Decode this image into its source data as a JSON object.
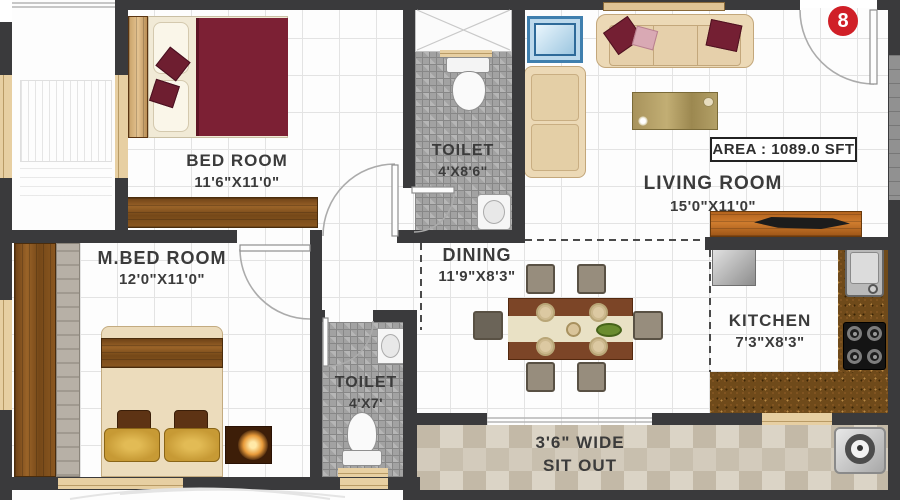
{
  "unit_badge": {
    "number": "8"
  },
  "area_box": {
    "label": "AREA : 1089.0 SFT"
  },
  "rooms": {
    "bedroom": {
      "name": "BED ROOM",
      "dims": "11'6\"X11'0\""
    },
    "toilet_top": {
      "name": "TOILET",
      "dims": "4'X8'6\""
    },
    "living": {
      "name": "LIVING ROOM",
      "dims": "15'0\"X11'0\""
    },
    "master_bedroom": {
      "name": "M.BED ROOM",
      "dims": "12'0\"X11'0\""
    },
    "dining": {
      "name": "DINING",
      "dims": "11'9\"X8'3\""
    },
    "kitchen": {
      "name": "KITCHEN",
      "dims": "7'3\"X8'3\""
    },
    "toilet_bottom": {
      "name": "TOILET",
      "dims": "4'X7'"
    },
    "sitout": {
      "line1": "3'6\" WIDE",
      "line2": "SIT OUT"
    }
  },
  "colors": {
    "wall": "#3a3a3c",
    "bed_maroon": "#7c2034",
    "badge_red": "#d01f27",
    "counter_brown": "#6f4a1a",
    "pillow_gold": "#c79a35",
    "window_tan": "#e7cfa2",
    "sofa_cream": "#ecd9b6",
    "tile_gray": "#a2a2a2"
  }
}
